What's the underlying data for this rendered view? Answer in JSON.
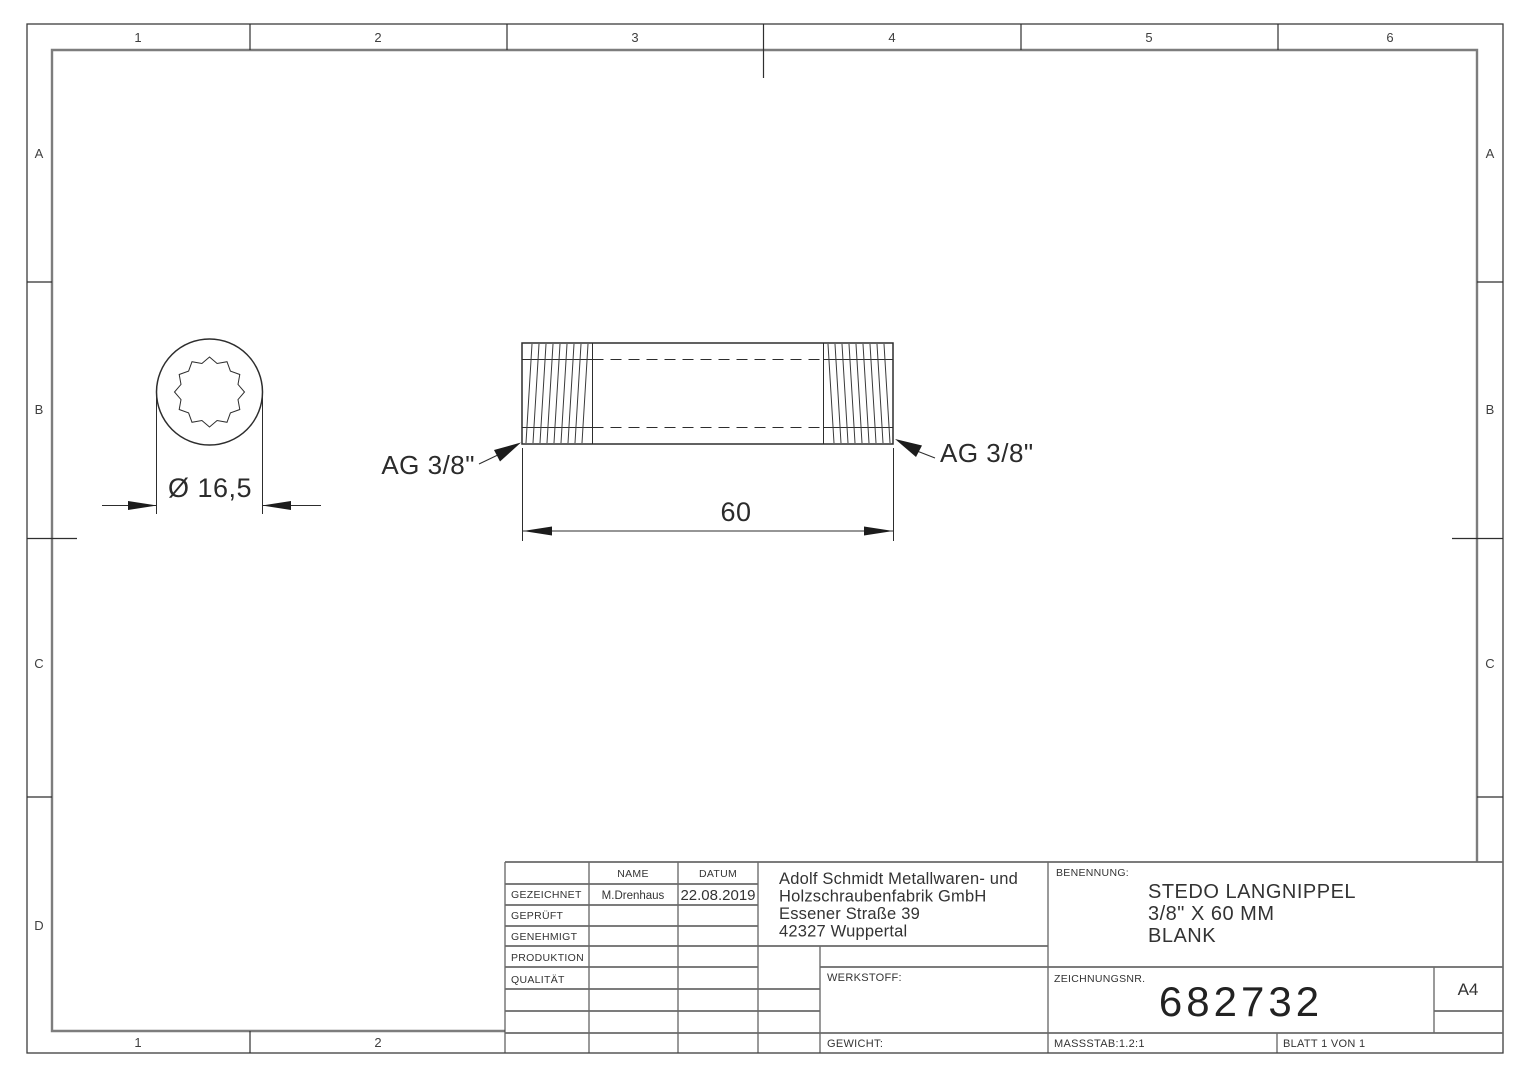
{
  "zones": {
    "top": [
      "1",
      "2",
      "3",
      "4",
      "5",
      "6"
    ],
    "bottom": [
      "1",
      "2"
    ],
    "left": [
      "A",
      "B",
      "C",
      "D"
    ],
    "right": [
      "A",
      "B",
      "C"
    ]
  },
  "views": {
    "end_view": {
      "diameter_dim": "Ø 16,5"
    },
    "side_view": {
      "length_dim": "60",
      "thread_label_left": "AG 3/8\"",
      "thread_label_right": "AG 3/8\""
    }
  },
  "title_block": {
    "header": {
      "name": "NAME",
      "datum": "DATUM"
    },
    "rows": [
      {
        "label": "GEZEICHNET",
        "name": "M.Drenhaus",
        "datum": "22.08.2019"
      },
      {
        "label": "GEPRÜFT",
        "name": "",
        "datum": ""
      },
      {
        "label": "GENEHMIGT",
        "name": "",
        "datum": ""
      },
      {
        "label": "PRODUKTION",
        "name": "",
        "datum": ""
      },
      {
        "label": "QUALITÄT",
        "name": "",
        "datum": ""
      }
    ],
    "company": {
      "line1": "Adolf Schmidt Metallwaren- und",
      "line2": "Holzschraubenfabrik GmbH",
      "line3": "Essener Straße 39",
      "line4": "42327 Wuppertal"
    },
    "benennung_label": "BENENNUNG:",
    "benennung": {
      "line1": "STEDO LANGNIPPEL",
      "line2": "3/8\" X 60 MM",
      "line3": "BLANK"
    },
    "werkstoff_label": "WERKSTOFF:",
    "gewicht_label": "GEWICHT:",
    "zeichnungsnr_label": "ZEICHNUNGSNR.",
    "zeichnungsnr": "682732",
    "format": "A4",
    "massstab": "MASSSTAB:1.2:1",
    "blatt": "BLATT 1 VON 1"
  }
}
